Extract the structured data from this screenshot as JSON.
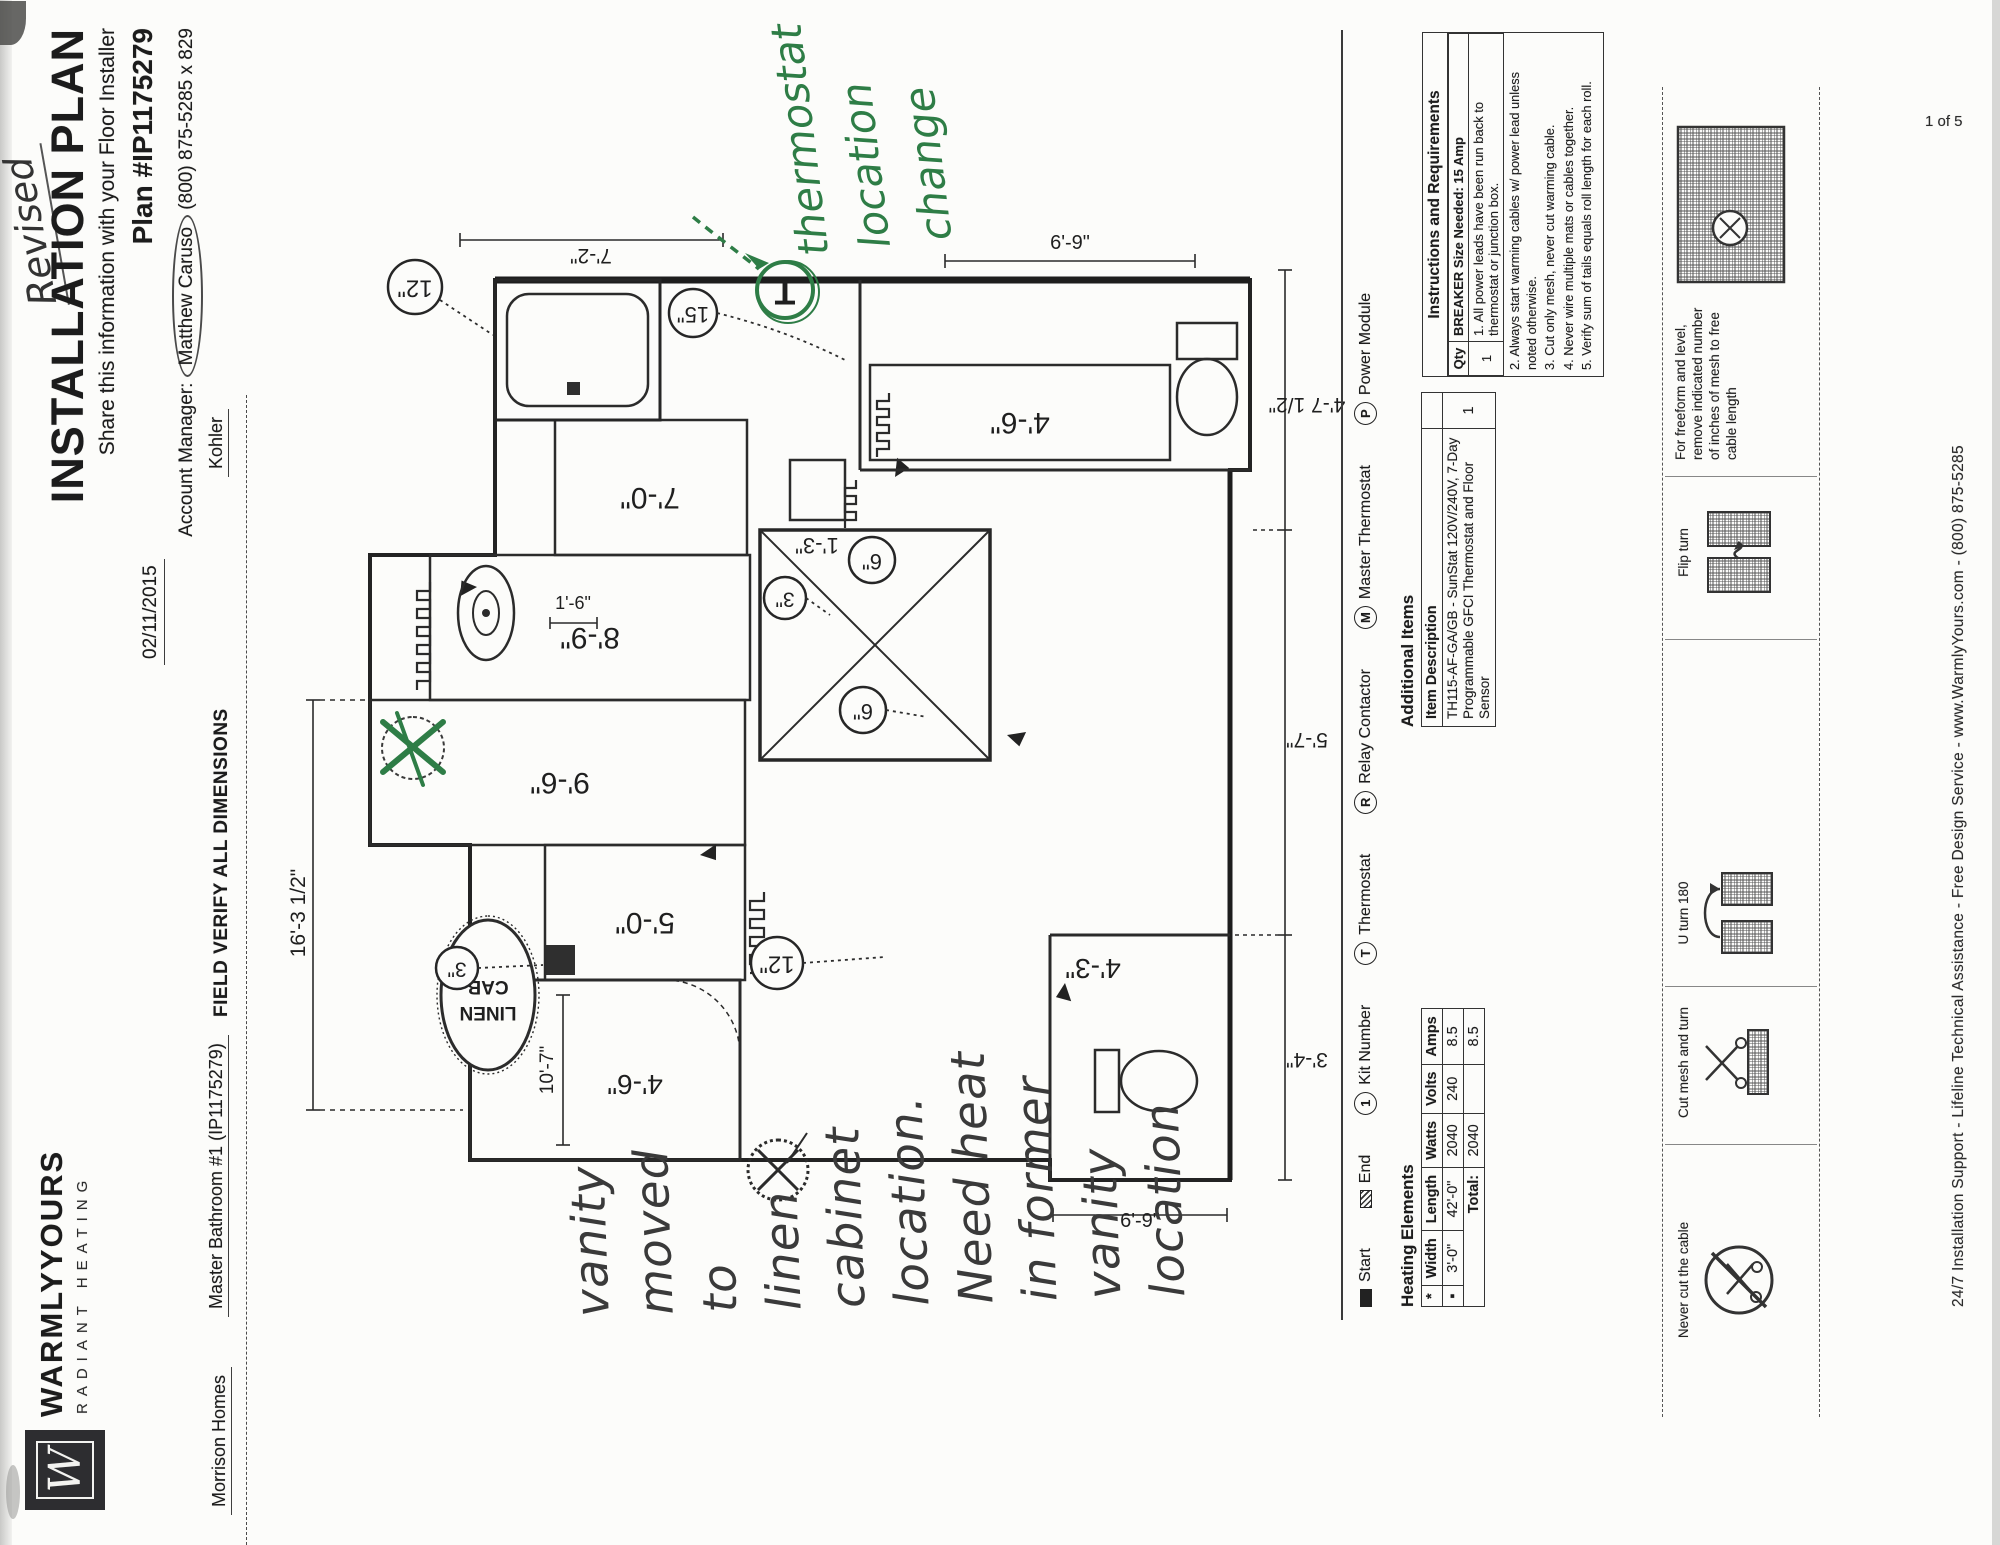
{
  "page": {
    "number": "1 of 5"
  },
  "header": {
    "brand_monogram": "W",
    "brand_name": "WARMLYYOURS",
    "brand_tagline": "RADIANT HEATING",
    "revised": "Revised",
    "title": "INSTALLATION PLAN",
    "subtitle": "Share this information with your Floor Installer",
    "plan_number": "Plan #IP1175279",
    "date": "02/11/2015",
    "account_manager_label": "Account Manager:",
    "account_manager_name": "Matthew Caruso",
    "account_manager_phone": "(800) 875-5285 x 829",
    "builder": "Morrison Homes",
    "project": "Master Bathroom #1 (IP1175279)",
    "field_verify": "FIELD VERIFY ALL DIMENSIONS",
    "fixture_brand": "Kohler"
  },
  "plan": {
    "mats": {
      "m1": "9'-6\"",
      "m2": "8'-9\"",
      "m3": "7'-0\"",
      "m4": "5'-0\"",
      "m5": "4'-6\"",
      "m6": "1'-3\""
    },
    "rooms": {
      "vanity": "4'-6\"",
      "water_closet": "4'-3\""
    },
    "linen_line1": "LINEN",
    "linen_line2": "CAB",
    "callouts": {
      "c12a": "12\"",
      "c15": "15\"",
      "c3a": "3\"",
      "c6a": "6\"",
      "c6b": "6\"",
      "c3b": "3\"",
      "c12b": "12\"",
      "thermostat": "T"
    },
    "dims": {
      "top": "16'-3 1/2\"",
      "tub": "7'-2\"",
      "room_width": "10'-7\"",
      "small": "1'-6\"",
      "right": "6'-9\"",
      "left": "6'-9\"",
      "bottom_left": "3'-4\"",
      "bottom_mid": "5'-7\"",
      "bottom_right": "4'-7 1/2\""
    }
  },
  "annotations": {
    "thermostat_note": [
      "thermostat",
      "location",
      "change"
    ],
    "vanity_note": [
      "vanity",
      "moved",
      "to",
      "linen",
      "cabinet",
      "location.",
      "Need heat",
      "in former",
      "vanity",
      "location"
    ]
  },
  "legend": {
    "items": [
      {
        "symbol": "start",
        "label": "Start"
      },
      {
        "symbol": "end",
        "label": "End"
      },
      {
        "symbol": "1",
        "label": "Kit Number"
      },
      {
        "symbol": "T",
        "label": "Thermostat"
      },
      {
        "symbol": "R",
        "label": "Relay Contactor"
      },
      {
        "symbol": "M",
        "label": "Master Thermostat"
      },
      {
        "symbol": "P",
        "label": "Power Module"
      }
    ]
  },
  "tables": {
    "heating_elements": {
      "title": "Heating Elements",
      "col_star": "*",
      "col_width": "Width",
      "col_length": "Length",
      "col_watts": "Watts",
      "col_volts": "Volts",
      "col_amps": "Amps",
      "row": {
        "star": "▪",
        "width": "3'-0\"",
        "length": "42'-0\"",
        "watts": "2040",
        "volts": "240",
        "amps": "8.5"
      },
      "total_label": "Total:",
      "total_watts": "2040",
      "total_amps": "8.5"
    },
    "additional_items": {
      "title": "Additional Items",
      "col_item": "Item Description",
      "row_item": "TH115-AF-GA/GB - SunStat 120V/240V, 7-Day Programmable GFCI Thermostat and Floor Sensor",
      "row_qty": "1"
    },
    "instructions": {
      "title": "Instructions and Requirements",
      "qty_label": "Qty",
      "breaker": "BREAKER Size Needed: 15 Amp",
      "item1_qty": "1",
      "items": [
        "1. All power leads have been run back to thermostat or junction box.",
        "2. Always start warming cables w/ power lead unless noted otherwise.",
        "3. Cut only mesh, never cut warming cable.",
        "4. Never wire multiple mats or cables together.",
        "5. Verify sum of tails equals roll length for each roll."
      ]
    }
  },
  "icon_strip": {
    "cells": [
      {
        "label": "Never cut the cable"
      },
      {
        "label": "Cut mesh and turn"
      },
      {
        "label": "U turn 180"
      },
      {
        "label": "Flip turn"
      },
      {
        "label": "For freeform and level, remove indicated number of inches of mesh to free cable length"
      }
    ]
  },
  "footer": {
    "support_line": "24/7 Installation Support - Lifeline Technical Assistance - Free Design Service - www.WarmlyYours.com - (800) 875-5285"
  }
}
